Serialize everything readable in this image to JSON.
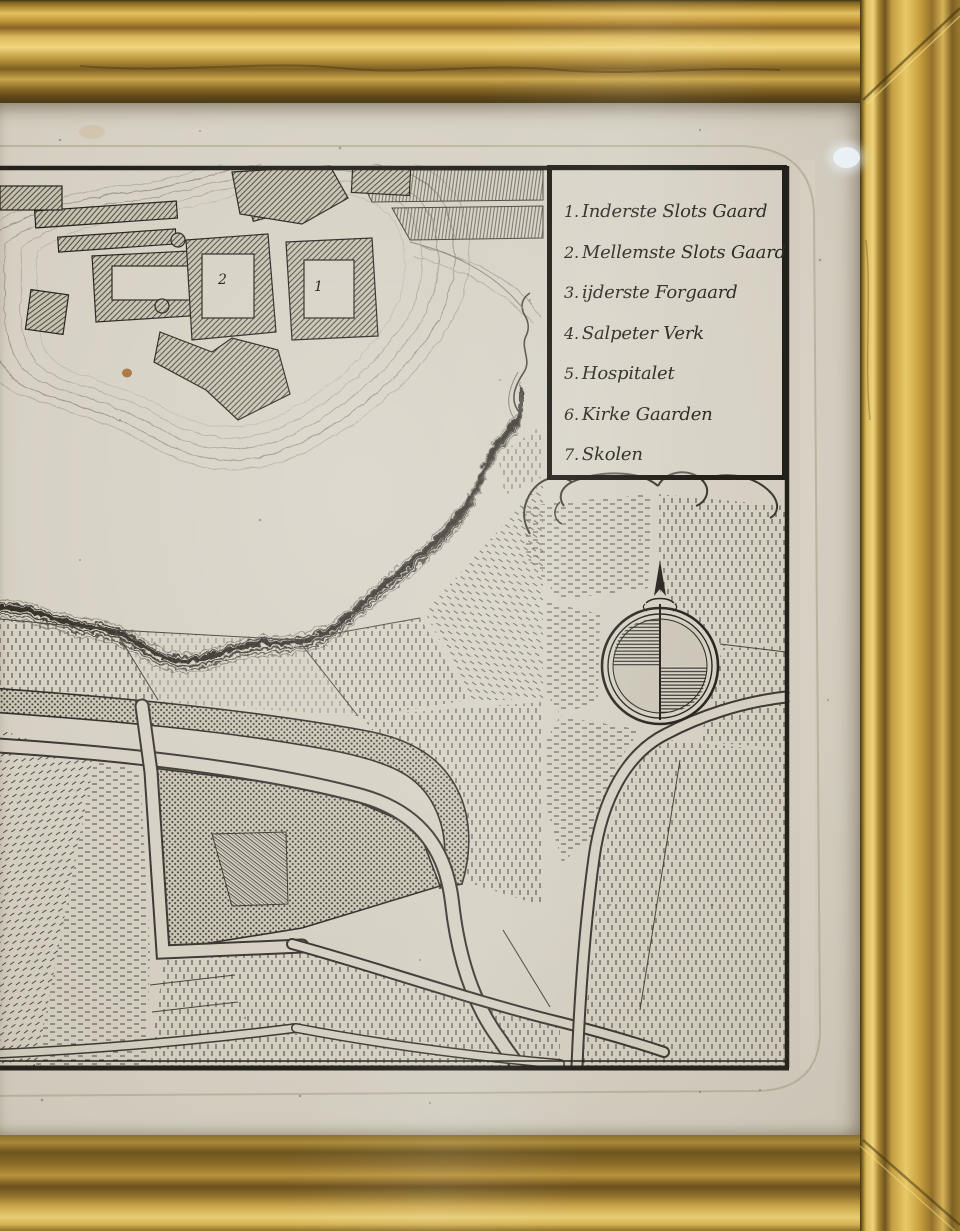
{
  "map": {
    "legend": {
      "items": [
        {
          "num": "1.",
          "label": "Inderste Slots Gaard"
        },
        {
          "num": "2.",
          "label": "Mellemste Slots Gaard"
        },
        {
          "num": "3.",
          "label": "ijderste Forgaard"
        },
        {
          "num": "4.",
          "label": "Salpeter Verk"
        },
        {
          "num": "5.",
          "label": "Hospitalet"
        },
        {
          "num": "6.",
          "label": "Kirke Gaarden"
        },
        {
          "num": "7.",
          "label": "Skolen"
        }
      ]
    },
    "castle_labels": [
      {
        "text": "2"
      },
      {
        "text": "1"
      }
    ],
    "compass_icon": "north-arrow-icon"
  },
  "colors": {
    "frame_gold": "#c39a3f",
    "paper": "#d6d1c4",
    "ink": "#2b2823",
    "foxing": "#a4682c",
    "legend_border": "#23201b"
  }
}
